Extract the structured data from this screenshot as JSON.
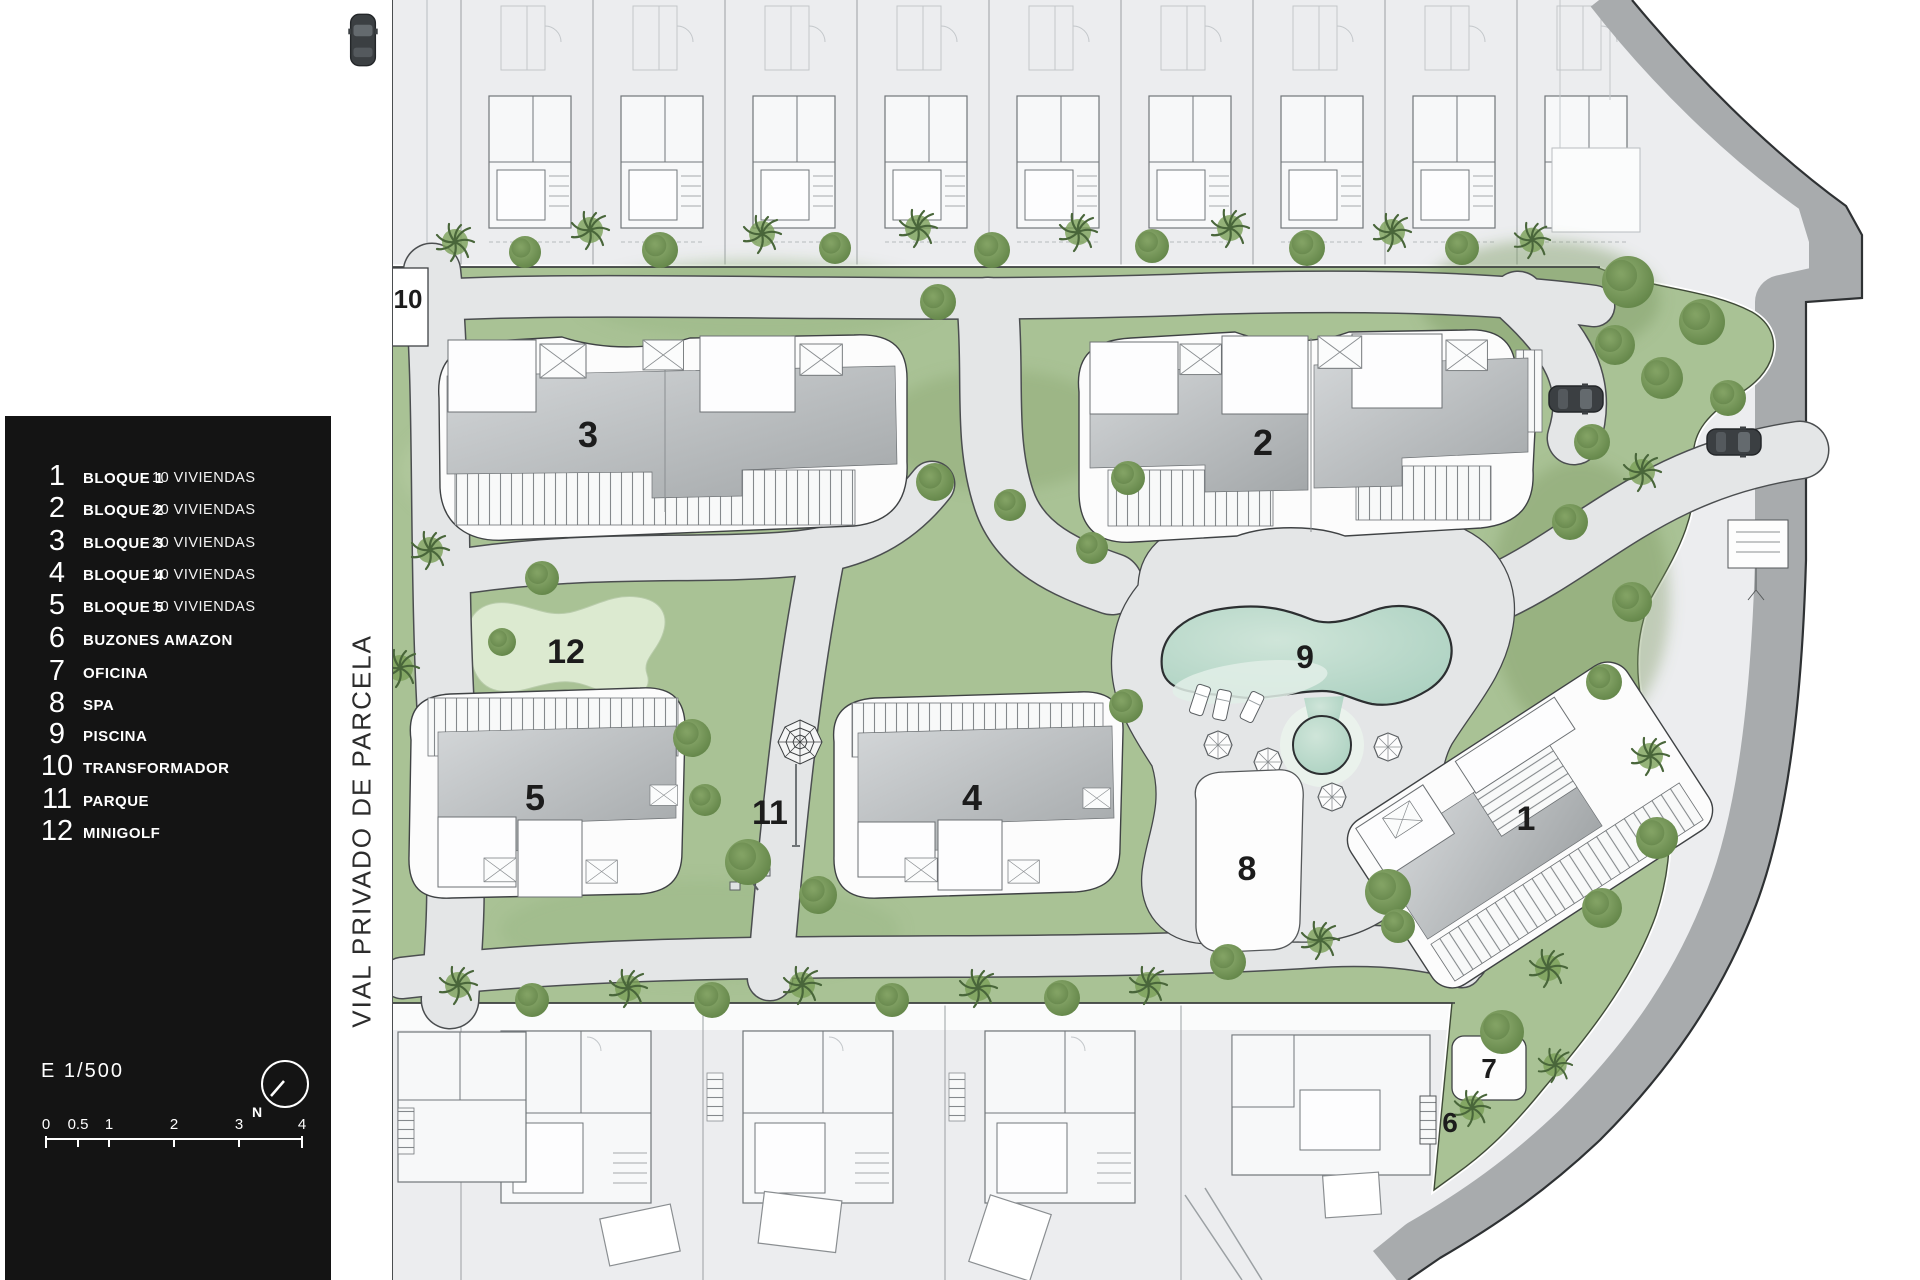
{
  "legend": {
    "items": [
      {
        "num": "1",
        "label": "BLOQUE 1",
        "detail": "10 VIVIENDAS"
      },
      {
        "num": "2",
        "label": "BLOQUE 2",
        "detail": "20 VIVIENDAS"
      },
      {
        "num": "3",
        "label": "BLOQUE 3",
        "detail": "20 VIVIENDAS"
      },
      {
        "num": "4",
        "label": "BLOQUE 4",
        "detail": "10 VIVIENDAS"
      },
      {
        "num": "5",
        "label": "BLOQUE 5",
        "detail": "10 VIVIENDAS"
      },
      {
        "num": "6",
        "label": "BUZONES AMAZON",
        "detail": ""
      },
      {
        "num": "7",
        "label": "OFICINA",
        "detail": ""
      },
      {
        "num": "8",
        "label": "SPA",
        "detail": ""
      },
      {
        "num": "9",
        "label": "PISCINA",
        "detail": ""
      },
      {
        "num": "10",
        "label": "TRANSFORMADOR",
        "detail": ""
      },
      {
        "num": "11",
        "label": "PARQUE",
        "detail": ""
      },
      {
        "num": "12",
        "label": "MINIGOLF",
        "detail": ""
      }
    ],
    "scale_text": "E 1/500",
    "north_label": "N",
    "scale_ticks": [
      "0",
      "0.5",
      "1",
      "2",
      "3",
      "4"
    ]
  },
  "road_label": "VIAL PRIVADO DE PARCELA",
  "plan_labels": {
    "block1": "1",
    "block2": "2",
    "block3": "3",
    "block4": "4",
    "block5": "5",
    "buzones": "6",
    "oficina": "7",
    "spa": "8",
    "piscina": "9",
    "transformador": "10",
    "parque": "11",
    "minigolf": "12"
  },
  "colors": {
    "panel_bg": "#141414",
    "panel_text": "#ffffff",
    "grass": "#a9c295",
    "grass_dark": "#5d8043",
    "path_gray": "#e4e6e7",
    "road_gray": "#a8abad",
    "water": "#b8d9c8",
    "water_light": "#e2efe7",
    "roof_gray": "#b9bdbf",
    "line_dark": "#3c3f41",
    "minigolf_green": "#dcead0",
    "outside": "#ffffff"
  }
}
